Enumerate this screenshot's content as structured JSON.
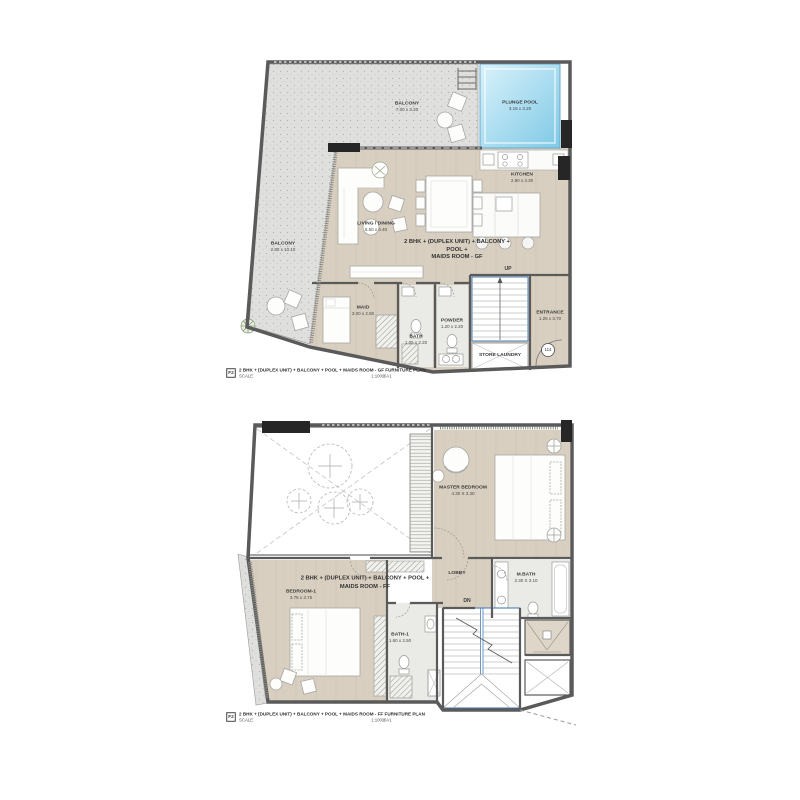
{
  "document": {
    "type": "architectural floor plan sheet",
    "unit_type": "2 BHK (DUPLEX UNIT)"
  },
  "colors": {
    "wall": "#5a5a5a",
    "column_black": "#262626",
    "wood_floor": "#d8cfc0",
    "balcony_floor": "#dfdfdd",
    "tile_floor": "#eaeae7",
    "pool_light": "#d9f2fb",
    "pool_dark": "#7fc9e6",
    "stair_accent": "#4a7fb5",
    "label_text": "#3a3a3a",
    "plant_green": "#7d9a6d"
  },
  "gf": {
    "center_label": "2 BHK + (DUPLEX UNIT) + BALCONY + POOL +\nMAIDS ROOM - GF",
    "stair_direction": "UP",
    "unit_number": "114",
    "rooms": {
      "balcony_top": {
        "name": "BALCONY",
        "dims": "7.00 x 3.20"
      },
      "balcony_left": {
        "name": "BALCONY",
        "dims": "2.80 x 10.10"
      },
      "plunge_pool": {
        "name": "PLUNGE POOL",
        "dims": "3.15 x 3.20"
      },
      "living_dining": {
        "name": "LIVING / DINING",
        "dims": "5.50 x 4.40"
      },
      "kitchen": {
        "name": "KITCHEN",
        "dims": "2.90 x 4.30"
      },
      "maid": {
        "name": "MAID",
        "dims": "3.00 x 2.80"
      },
      "bath": {
        "name": "BATH",
        "dims": "1.05 x 2.20"
      },
      "powder": {
        "name": "POWDER",
        "dims": "1.20 x 2.20"
      },
      "store_laundry": {
        "name": "STORE LAUNDRY"
      },
      "entrance": {
        "name": "ENTRANCE",
        "dims": "1.25 x 3.70"
      }
    },
    "footer": {
      "sheet_icon": "F2",
      "title": "2 BHK + (DUPLEX UNIT) + BALCONY + POOL + MAIDS ROOM - GF  FURNITURE PLAN",
      "scale_label": "SCALE",
      "scale_value": "1:100@A1"
    }
  },
  "ff": {
    "center_label": "2 BHK + (DUPLEX UNIT) + BALCONY + POOL +\nMAIDS ROOM - FF",
    "stair_direction": "DN",
    "rooms": {
      "master_bedroom": {
        "name": "MASTER BEDROOM",
        "dims": "4.30 X 3.30"
      },
      "bedroom_1": {
        "name": "BEDROOM-1",
        "dims": "3.75 x 3.75"
      },
      "lobby": {
        "name": "LOBBY"
      },
      "m_bath": {
        "name": "M.BATH",
        "dims": "2.30 X 3.10"
      },
      "bath_1": {
        "name": "BATH-1",
        "dims": "1.60 x 2.50"
      }
    },
    "footer": {
      "sheet_icon": "F2",
      "title": "2 BHK + (DUPLEX UNIT) + BALCONY + POOL + MAIDS ROOM - FF  FURNITURE PLAN",
      "scale_label": "SCALE",
      "scale_value": "1:100@A1"
    }
  }
}
